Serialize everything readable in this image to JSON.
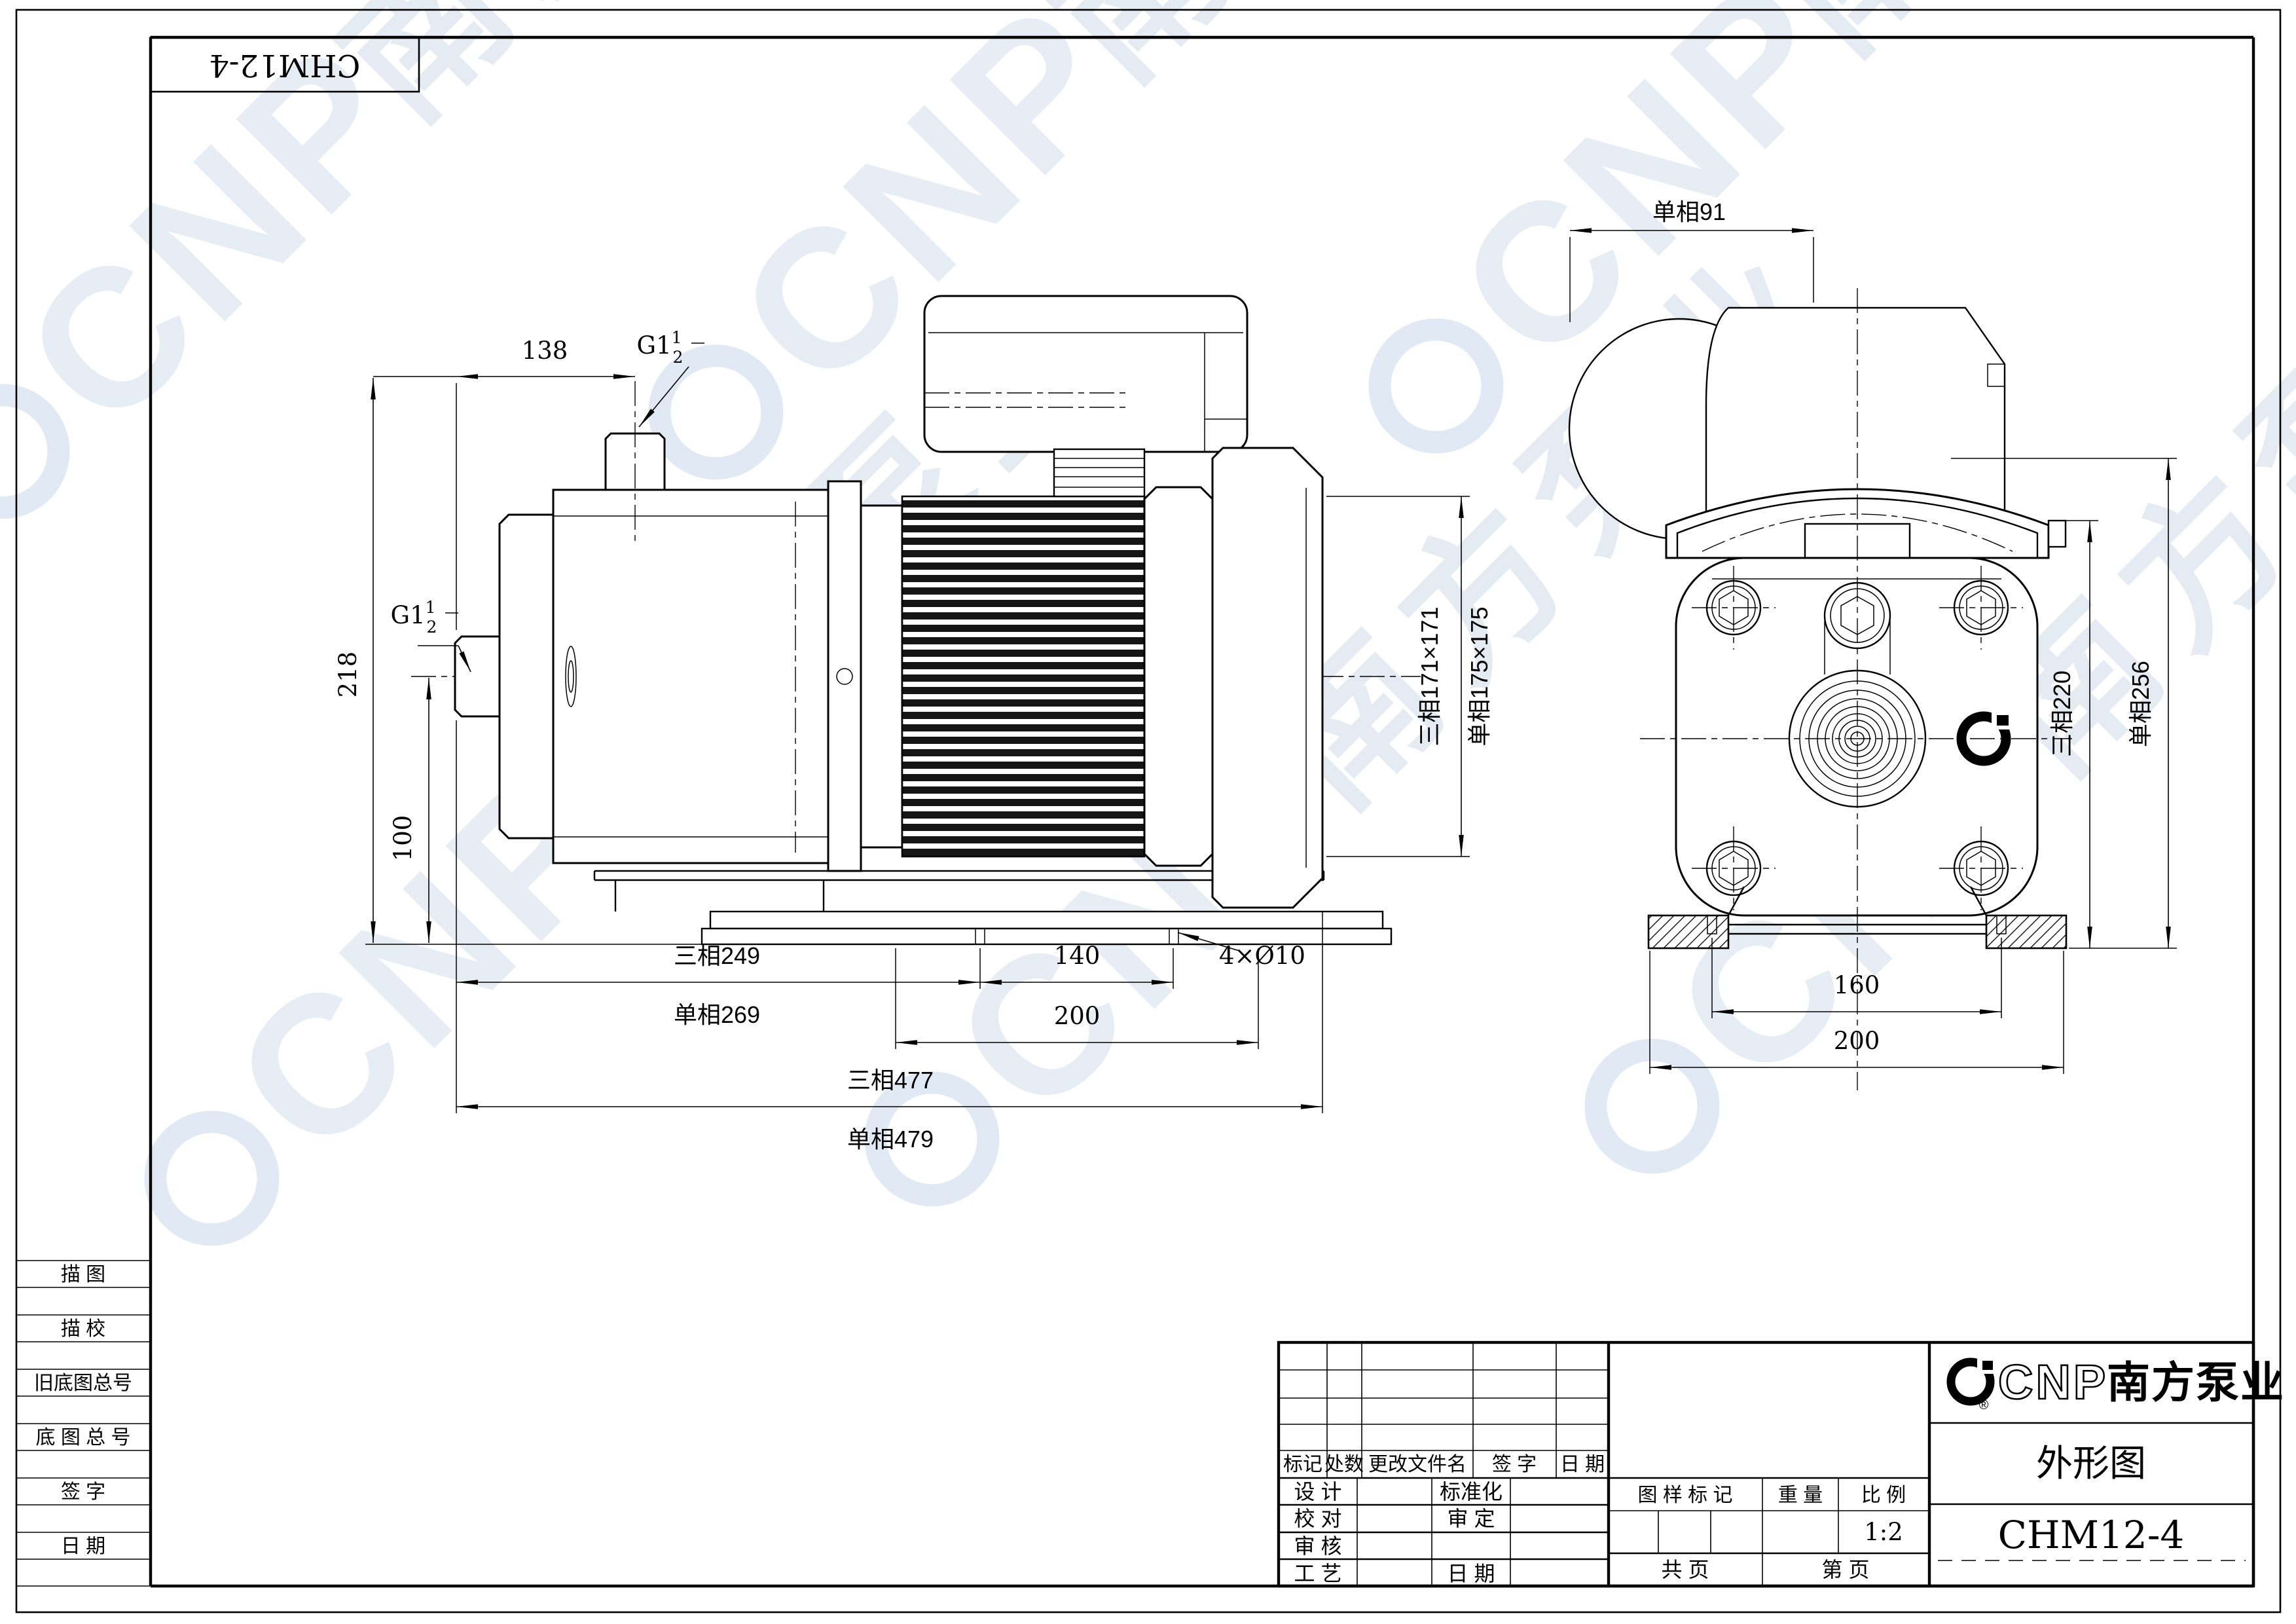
{
  "fold_label": "CHM12-4",
  "watermark": {
    "cnp": "CNP",
    "brand": "南方泵业"
  },
  "side_view": {
    "thread_top": {
      "base": "G1",
      "num": "1",
      "den": "2"
    },
    "thread_left": {
      "base": "G1",
      "num": "1",
      "den": "2"
    },
    "dims": {
      "offset_top": "138",
      "height_total": "218",
      "axis_height": "100",
      "len_3ph": "三相249",
      "len_1ph": "单相269",
      "foot_pitch": "140",
      "holes": "4×Ø10",
      "foot_len": "200",
      "total_3ph": "三相477",
      "total_1ph": "单相479",
      "frame_3ph": "三相171×171",
      "frame_1ph": "单相175×175"
    }
  },
  "front_view": {
    "dims": {
      "offset_1ph": "单相91",
      "height_3ph": "三相220",
      "height_1ph": "单相256",
      "bolt_span": "160",
      "base_width": "200"
    }
  },
  "sidebar": {
    "rows": [
      "描  图",
      "描  校",
      "旧底图总号",
      "底 图 总 号",
      "签  字",
      "日  期"
    ]
  },
  "title_block": {
    "revision_header": [
      "标记",
      "处数",
      "更改文件名",
      "签  字",
      "日  期"
    ],
    "left_rows": [
      [
        "设  计",
        "标准化"
      ],
      [
        "校  对",
        "审  定"
      ],
      [
        "审  核",
        ""
      ],
      [
        "工  艺",
        "日  期"
      ]
    ],
    "stamp_header": [
      "图 样 标 记",
      "重  量",
      "比  例"
    ],
    "scale_value": "1:2",
    "pages_total": "共    页",
    "pages_no": "第    页",
    "company_cnp": "CNP",
    "company_name": "南方泵业",
    "doc_type": "外形图",
    "model": "CHM12-4"
  }
}
